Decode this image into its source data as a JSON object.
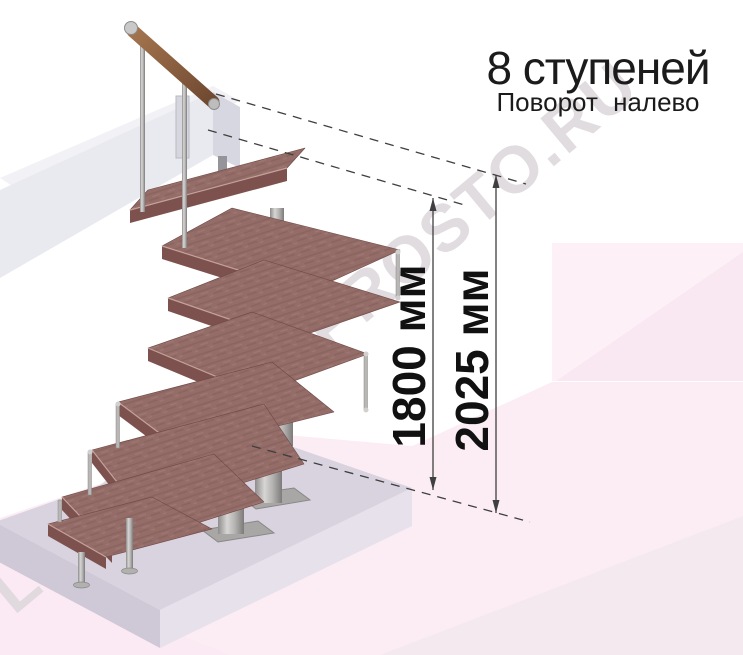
{
  "illustration": {
    "title_line1": "8 ступеней",
    "title_line2": "Поворот налево",
    "dimension_inner": "1800 мм",
    "dimension_outer": "2025 мм",
    "watermark": "LESTNITSA-PROSTO.RU",
    "colors": {
      "wood": "#946c68",
      "wood_edge": "#7d524e",
      "metal": "#b5b3b1",
      "slab": "#d9d3e0",
      "background_pink": "#fbecf4",
      "annotation": "#3f3f3f",
      "text": "#1b1b1b",
      "watermark_gray": "#dcd7da"
    }
  }
}
